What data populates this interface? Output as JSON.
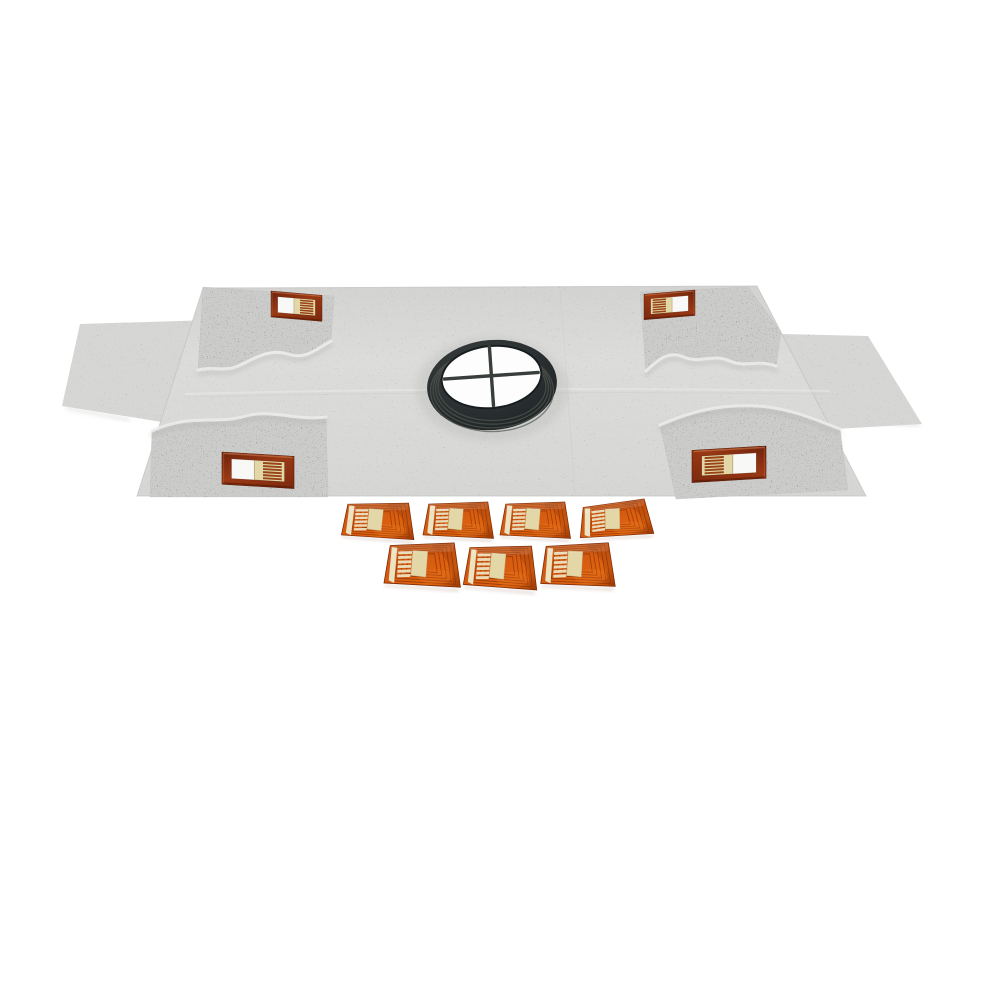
{
  "scene": {
    "description": "Product photo on a white background: light-gray fleece waterproofing membrane sheet with folded corner flaps, a central dark rubber drain gasket with cross divider, four copper sensor patches on the corners, and seven loose orange flexible sensor pads arranged in two rows below",
    "object_counts": {
      "membrane_sheet": 1,
      "side_wings": 2,
      "corner_flaps": 4,
      "drain_gasket": 1,
      "corner_patches": 4,
      "loose_sensor_pads": 7
    },
    "loose_pad_rows": [
      4,
      3
    ]
  },
  "palette": {
    "background": "#ffffff",
    "membrane-base": "#d9d9d7",
    "membrane-wing": "#d6d6d4",
    "membrane-flap": "#cccccb",
    "membrane-edge": "#c2c2c0",
    "crease-light": "#ededeb",
    "drain-dark": "#1e2326",
    "drain-mid": "#3d433f",
    "drain-rib": "#51574f",
    "drain-opening": "#fdfdfd",
    "cross-bar": "#383e3a",
    "pad-orange": "#d45a10",
    "pad-orange-deep": "#a64108",
    "pad-orange-dark": "#7e2b06",
    "pad-trace": "#8e3407",
    "pad-beige": "#e3d7a8",
    "pad-strip": "#ece3c2",
    "patch-copper": "#9a3814",
    "patch-copper-dark": "#6e220c",
    "patch-sheen": "#cf8150",
    "patch-window": "#f8f8f6",
    "shadow-warm": "#c9b6ac",
    "shadow-gray": "#b7b7b5"
  },
  "corner_patches": {
    "count": 4,
    "items": [
      {
        "name": "corner-patch-top-left",
        "transform": "translate(271,291) scale(0.51,0.50) skewY(5)"
      },
      {
        "name": "corner-patch-top-right",
        "transform": "translate(695,290) scale(-0.51,0.49) skewY(5)"
      },
      {
        "name": "corner-patch-bottom-left",
        "transform": "translate(222,452) scale(0.72,0.62) skewY(4)"
      },
      {
        "name": "corner-patch-bottom-right",
        "transform": "translate(766,446) scale(-0.74,0.62) skewY(4)"
      }
    ]
  },
  "loose_sensors": {
    "count": 7,
    "items": [
      {
        "name": "sensor-pad-1",
        "transform": "translate(342,502) rotate(1) scale(0.74,0.70)"
      },
      {
        "name": "sensor-pad-2",
        "transform": "translate(423,502) scale(0.72,0.70)"
      },
      {
        "name": "sensor-pad-3",
        "transform": "translate(500,502) scale(0.72,0.70)"
      },
      {
        "name": "sensor-pad-4",
        "transform": "translate(577,506) rotate(-6) scale(0.75,0.68)"
      },
      {
        "name": "sensor-pad-5",
        "transform": "translate(384,543) scale(0.78,0.85)"
      },
      {
        "name": "sensor-pad-6",
        "transform": "translate(464,545) rotate(1) scale(0.75,0.84)"
      },
      {
        "name": "sensor-pad-7",
        "transform": "translate(540,544) rotate(-1) scale(0.76,0.84)"
      }
    ]
  }
}
